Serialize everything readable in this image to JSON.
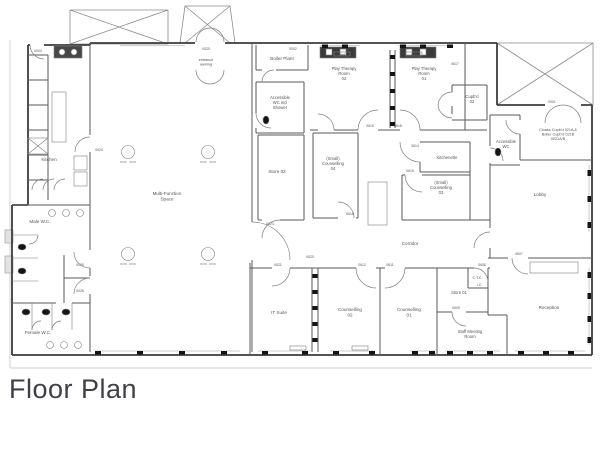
{
  "title": {
    "text": "Floor Plan"
  },
  "plan": {
    "rooms": [
      {
        "id": "kitchen",
        "lines": [
          "Kitchen"
        ],
        "x": 49,
        "y": 161
      },
      {
        "id": "male-wc",
        "lines": [
          "Male W.C."
        ],
        "x": 40,
        "y": 223
      },
      {
        "id": "female-wc",
        "lines": [
          "Female W.C."
        ],
        "x": 38,
        "y": 334
      },
      {
        "id": "multi-function-space",
        "lines": [
          "Multi-Function",
          "Space"
        ],
        "x": 167,
        "y": 195
      },
      {
        "id": "boiler-plant",
        "lines": [
          "Boiler Plant"
        ],
        "x": 282,
        "y": 60
      },
      {
        "id": "accessible-wc-shower",
        "lines": [
          "Accessible",
          "WC incl",
          "Shower"
        ],
        "x": 280,
        "y": 99,
        "fs": 4.2
      },
      {
        "id": "play-therapy-02",
        "lines": [
          "Play Therapy",
          "Room",
          "02"
        ],
        "x": 344,
        "y": 70,
        "fs": 4.2
      },
      {
        "id": "play-therapy-01",
        "lines": [
          "Play Therapy",
          "Room",
          "01"
        ],
        "x": 424,
        "y": 70,
        "fs": 4.2
      },
      {
        "id": "cupbd-02",
        "lines": [
          "Cupb'd",
          "02"
        ],
        "x": 472,
        "y": 98,
        "fs": 4.2
      },
      {
        "id": "cloaks-cupbd",
        "lines": [
          "Cloaks Cupb'd 021A &",
          "Boiler Cupb'd 021B",
          "0021A/B"
        ],
        "x": 558,
        "y": 131,
        "fs": 3.8
      },
      {
        "id": "accessible-wc",
        "lines": [
          "Accessible",
          "WC"
        ],
        "x": 506,
        "y": 143,
        "fs": 4.2
      },
      {
        "id": "lobby",
        "lines": [
          "Lobby"
        ],
        "x": 540,
        "y": 196
      },
      {
        "id": "kitchenette",
        "lines": [
          "Kitchenette"
        ],
        "x": 447,
        "y": 159,
        "fs": 4.2
      },
      {
        "id": "small-counselling-04",
        "lines": [
          "(Small)",
          "Counselling",
          "04"
        ],
        "x": 333,
        "y": 160,
        "fs": 4.2
      },
      {
        "id": "small-counselling-03",
        "lines": [
          "(Small)",
          "Counselling",
          "03"
        ],
        "x": 441,
        "y": 184,
        "fs": 4.2
      },
      {
        "id": "store-02",
        "lines": [
          "Store 02"
        ],
        "x": 277,
        "y": 173
      },
      {
        "id": "corridor",
        "lines": [
          "Corridor"
        ],
        "x": 410,
        "y": 245
      },
      {
        "id": "it-suite",
        "lines": [
          "IT Suite"
        ],
        "x": 279,
        "y": 314
      },
      {
        "id": "counselling-02",
        "lines": [
          "Counselling",
          "02"
        ],
        "x": 350,
        "y": 311
      },
      {
        "id": "counselling-01",
        "lines": [
          "Counselling",
          "01"
        ],
        "x": 409,
        "y": 311
      },
      {
        "id": "store-01",
        "lines": [
          "Store 01"
        ],
        "x": 459,
        "y": 294,
        "fs": 4.2
      },
      {
        "id": "ctc",
        "lines": [
          "C.T.C"
        ],
        "x": 477,
        "y": 279,
        "fs": 3.6
      },
      {
        "id": "ic",
        "lines": [
          "I.C"
        ],
        "x": 479,
        "y": 286,
        "fs": 3.6
      },
      {
        "id": "staff-meeting",
        "lines": [
          "Staff Meeting",
          "Room"
        ],
        "x": 470,
        "y": 333,
        "fs": 4.2
      },
      {
        "id": "reception",
        "lines": [
          "Reception"
        ],
        "x": 549,
        "y": 309
      },
      {
        "id": "entrance-awning",
        "lines": [
          "entrance",
          "awning"
        ],
        "x": 206,
        "y": 61,
        "fs": 3.8
      },
      {
        "id": "rad-1",
        "lines": [
          "Rad"
        ],
        "x": 342,
        "y": 56,
        "fs": 3.2
      },
      {
        "id": "rad-2",
        "lines": [
          "Rad"
        ],
        "x": 414,
        "y": 56,
        "fs": 3.2
      }
    ],
    "door_tags": [
      {
        "t": "0004",
        "x": 38,
        "y": 52
      },
      {
        "t": "0024",
        "x": 99,
        "y": 151
      },
      {
        "t": "0020",
        "x": 206,
        "y": 50
      },
      {
        "t": "0002",
        "x": 293,
        "y": 50
      },
      {
        "t": "0023",
        "x": 270,
        "y": 225
      },
      {
        "t": "0620",
        "x": 310,
        "y": 258
      },
      {
        "t": "0025",
        "x": 80,
        "y": 266
      },
      {
        "t": "0026",
        "x": 80,
        "y": 292
      },
      {
        "t": "0619",
        "x": 370,
        "y": 127
      },
      {
        "t": "0618",
        "x": 398,
        "y": 127
      },
      {
        "t": "0617",
        "x": 455,
        "y": 65
      },
      {
        "t": "0616",
        "x": 350,
        "y": 215
      },
      {
        "t": "0615",
        "x": 410,
        "y": 172
      },
      {
        "t": "0614",
        "x": 415,
        "y": 147
      },
      {
        "t": "0001",
        "x": 552,
        "y": 103
      },
      {
        "t": "0607",
        "x": 519,
        "y": 255
      },
      {
        "t": "0608",
        "x": 482,
        "y": 266
      },
      {
        "t": "0609",
        "x": 456,
        "y": 309
      },
      {
        "t": "0611",
        "x": 390,
        "y": 266
      },
      {
        "t": "0612",
        "x": 362,
        "y": 266
      },
      {
        "t": "0621",
        "x": 278,
        "y": 266
      }
    ]
  }
}
